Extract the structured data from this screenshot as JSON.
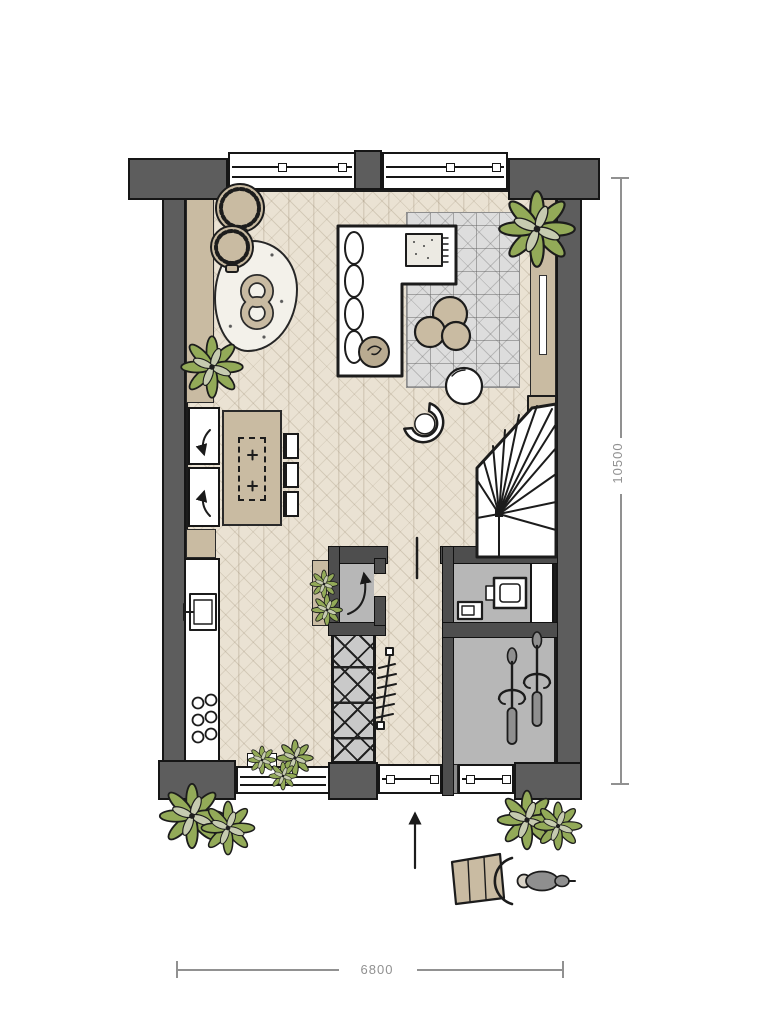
{
  "title": "ground-floor-plan",
  "dimensions": {
    "vertical": {
      "label": "10500"
    },
    "horizontal": {
      "label": "6800"
    }
  },
  "palette": {
    "wall": "#5d5d5d",
    "outline": "#1c1c1c",
    "floor": "#eae2d3",
    "floor_line": "#ccc2af",
    "tan": "#c9bba2",
    "room_grey": "#b7b7b7",
    "rug_grey": "#dddddd",
    "plant_green": "#93aa58",
    "plant_light": "#c6cbb0",
    "bike_grey": "#8f8f8f",
    "dim": "#919191",
    "white": "#ffffff"
  },
  "legend": {
    "rooms": [
      "living-room",
      "open-kitchen",
      "hallway",
      "wc",
      "bike-storage",
      "meter-cupboard",
      "winder-stairs"
    ],
    "furniture": [
      "corner-sofa",
      "area-rug",
      "poufs",
      "ball-chair",
      "armchair",
      "dining-table",
      "dining-chairs",
      "sideboard",
      "tv-cabinet",
      "rattan-chairs",
      "sheepskin-rug",
      "knot-cushion",
      "kitchen-counter",
      "sink",
      "hob",
      "tall-appliances",
      "wardrobe-cabinet",
      "coat-rack",
      "toilet",
      "hand-basin",
      "bicycles",
      "cargo-bike",
      "potted-plants"
    ]
  }
}
